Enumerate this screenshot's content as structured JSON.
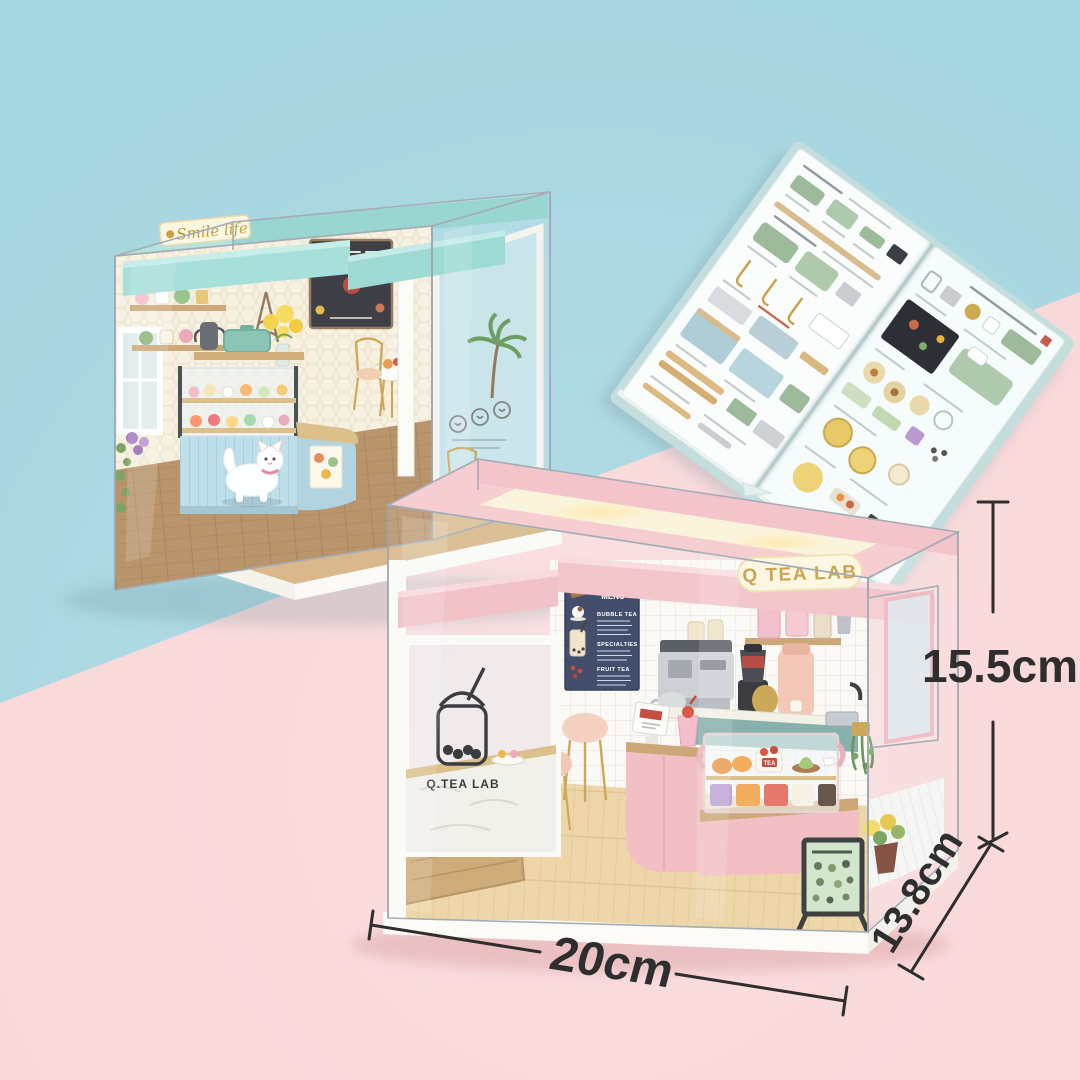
{
  "background": {
    "top_left_color": "#a6d6e0",
    "bottom_right_color": "#f9d7d8"
  },
  "dimensions": {
    "width": "20cm",
    "height": "15.5cm",
    "depth": "13.8cm",
    "line_color": "#2e2e2e"
  },
  "blue_shop": {
    "sign": "Smile life",
    "sign_text_color": "#bd9433",
    "roof_color": "#9fdcd6",
    "counter_color": "#abd0dd"
  },
  "pink_shop": {
    "sign": "Q TEA LAB",
    "window_decal": "Q.TEA LAB",
    "roof_color": "#f5c6ca",
    "counter_color": "#f2b9be",
    "cake_tag": "TEA",
    "menu_board": {
      "title": "TEA LAB",
      "subtitle": "MENU",
      "sections": [
        "BUBBLE TEA",
        "SPECIALTIES",
        "FRUIT TEA"
      ],
      "board_color": "#2f3a5c"
    }
  },
  "booklet": {
    "kind": "parts-instruction-manual",
    "page_color": "#fbfdfd",
    "cover_color": "#c4dede"
  },
  "icons": {
    "cat": "cat-figurine",
    "bubble_tea": "bubble-tea-cup-decal-icon",
    "palm": "palm-tree-decal-icon",
    "smileys": "smiley-faces-decal-icon",
    "eiffel": "eiffel-tower-icon",
    "chalkboard": "chalkboard-menu-icon"
  }
}
